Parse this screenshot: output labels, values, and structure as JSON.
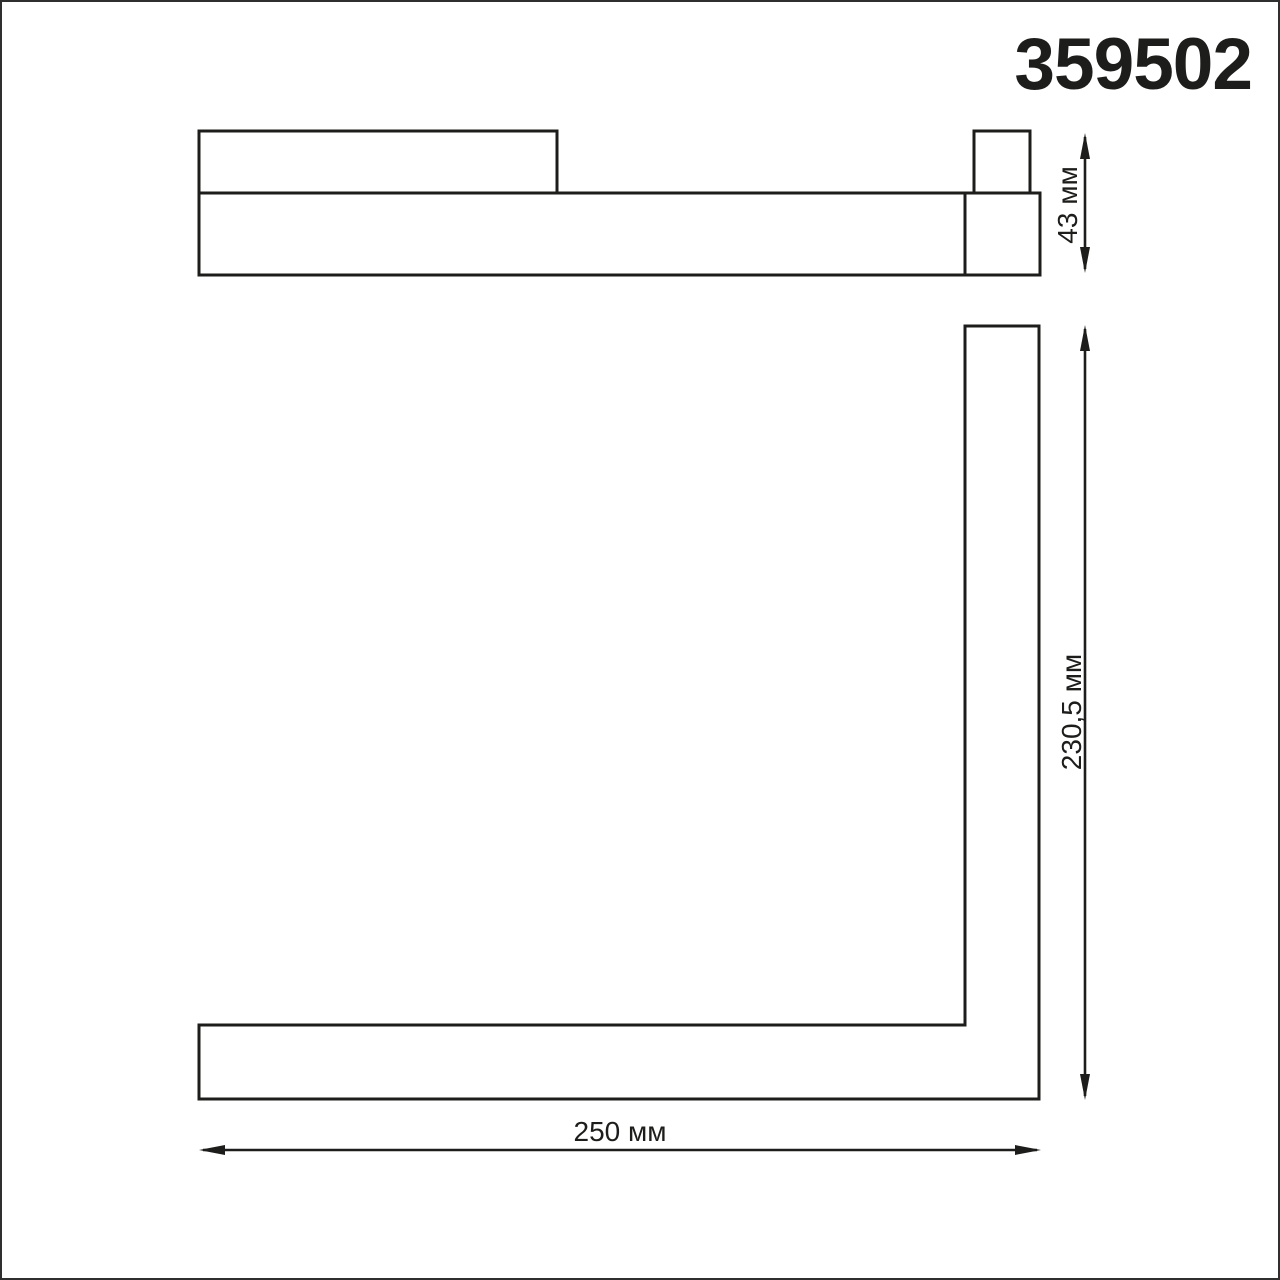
{
  "title": "359502",
  "dimensions": {
    "height": "43 мм",
    "depth": "230,5 мм",
    "width": "250 мм"
  },
  "colors": {
    "line": "#1d1d1b",
    "canvas_border": "#2f2f2f",
    "background": "#ffffff"
  }
}
